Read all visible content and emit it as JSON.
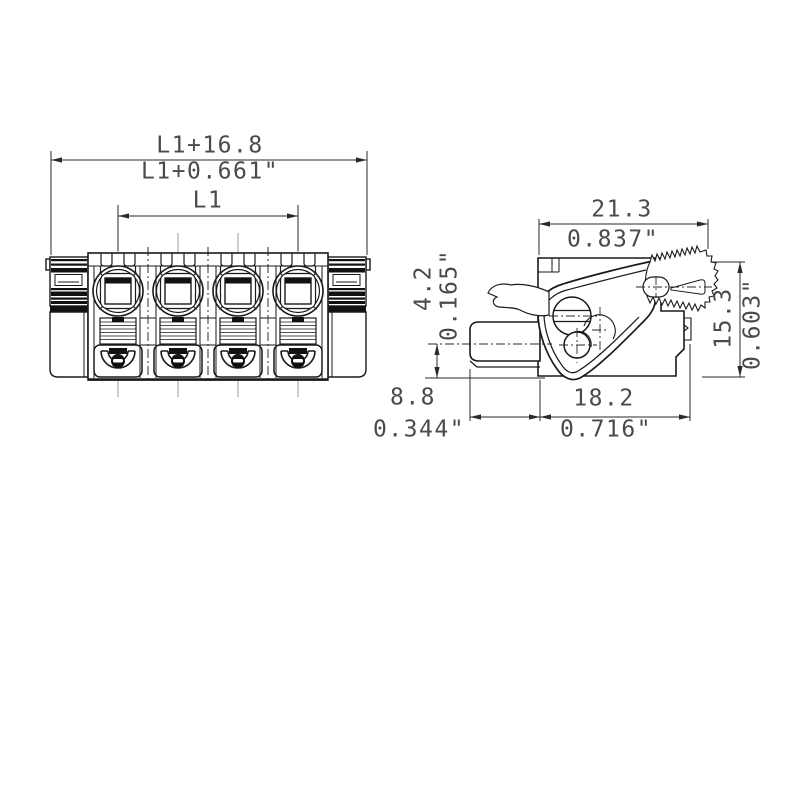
{
  "drawing_type": "terminal-block-connector-dimension-drawing",
  "front_view": {
    "overall_mm": "L1+16.8",
    "overall_in": "L1+0.661\"",
    "pitch": "L1"
  },
  "side_view": {
    "width_mm": "21.3",
    "width_in": "0.837\"",
    "offset_mm": "4.2",
    "offset_in": "0.165\"",
    "height_mm": "15.3",
    "height_in": "0.603\"",
    "protrusion_mm": "8.8",
    "protrusion_in": "0.344\"",
    "depth_mm": "18.2",
    "depth_in": "0.716\""
  },
  "colors": {
    "line": "#1a1a1a",
    "dimension_line": "#2a2a2a",
    "dimension_text": "#4a4a4a",
    "centerline_gray": "#9b9b9b",
    "background": "#ffffff"
  }
}
